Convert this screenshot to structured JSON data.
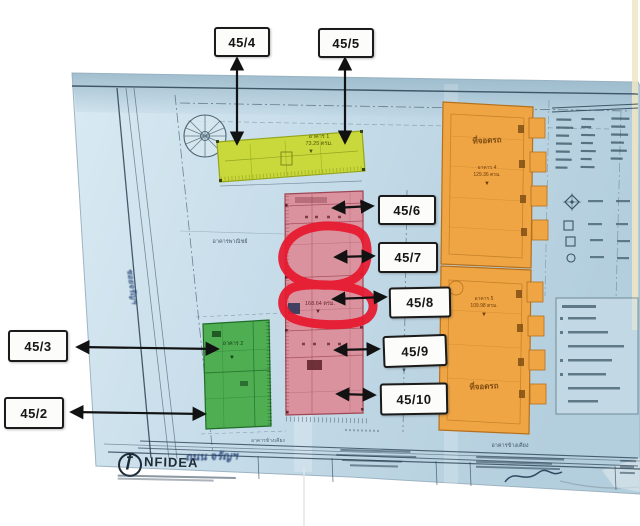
{
  "document": {
    "kind": "scanned site plan with unit callouts",
    "paper_color": "#c6dce9",
    "highlight_color": "#e6192e"
  },
  "callouts": [
    {
      "id": "45-4",
      "label": "45/4"
    },
    {
      "id": "45-5",
      "label": "45/5"
    },
    {
      "id": "45-6",
      "label": "45/6"
    },
    {
      "id": "45-7",
      "label": "45/7"
    },
    {
      "id": "45-8",
      "label": "45/8"
    },
    {
      "id": "45-9",
      "label": "45/9"
    },
    {
      "id": "45-10",
      "label": "45/10"
    },
    {
      "id": "45-3",
      "label": "45/3"
    },
    {
      "id": "45-2",
      "label": "45/2"
    }
  ],
  "buildings": {
    "yellow": {
      "name": "อาคาร 1",
      "area": "73.25 ตรม.",
      "color": "#c9d93c"
    },
    "pink": {
      "area": "168.64 ตรม.",
      "color": "#d9929e"
    },
    "green": {
      "name": "อาคาร 2",
      "color": "#4fae52"
    },
    "orange_upper": {
      "use": "ที่จอดรถ",
      "name": "อาคาร 4",
      "area": "129.36 ตรม.",
      "color": "#efa544"
    },
    "orange_lower": {
      "name": "อาคาร 5",
      "area": "109.98 ตรม.",
      "use": "ที่จอดรถ",
      "color": "#efa544"
    }
  },
  "annotations": {
    "commercial_label": "อาคารพาณิชย์",
    "neighbor_label": "อาคารข้างเคียง",
    "road_name": "ถนน จรัญฯ",
    "soi_name": "ซอยจรัญฯ"
  },
  "highlight": {
    "shape": "hand-drawn marker circle",
    "around_units": [
      "45/7",
      "45/8"
    ],
    "color": "#e6192e"
  },
  "title_block": {
    "logo_glyph": "ƒ",
    "logo_text": "NFIDEA"
  }
}
